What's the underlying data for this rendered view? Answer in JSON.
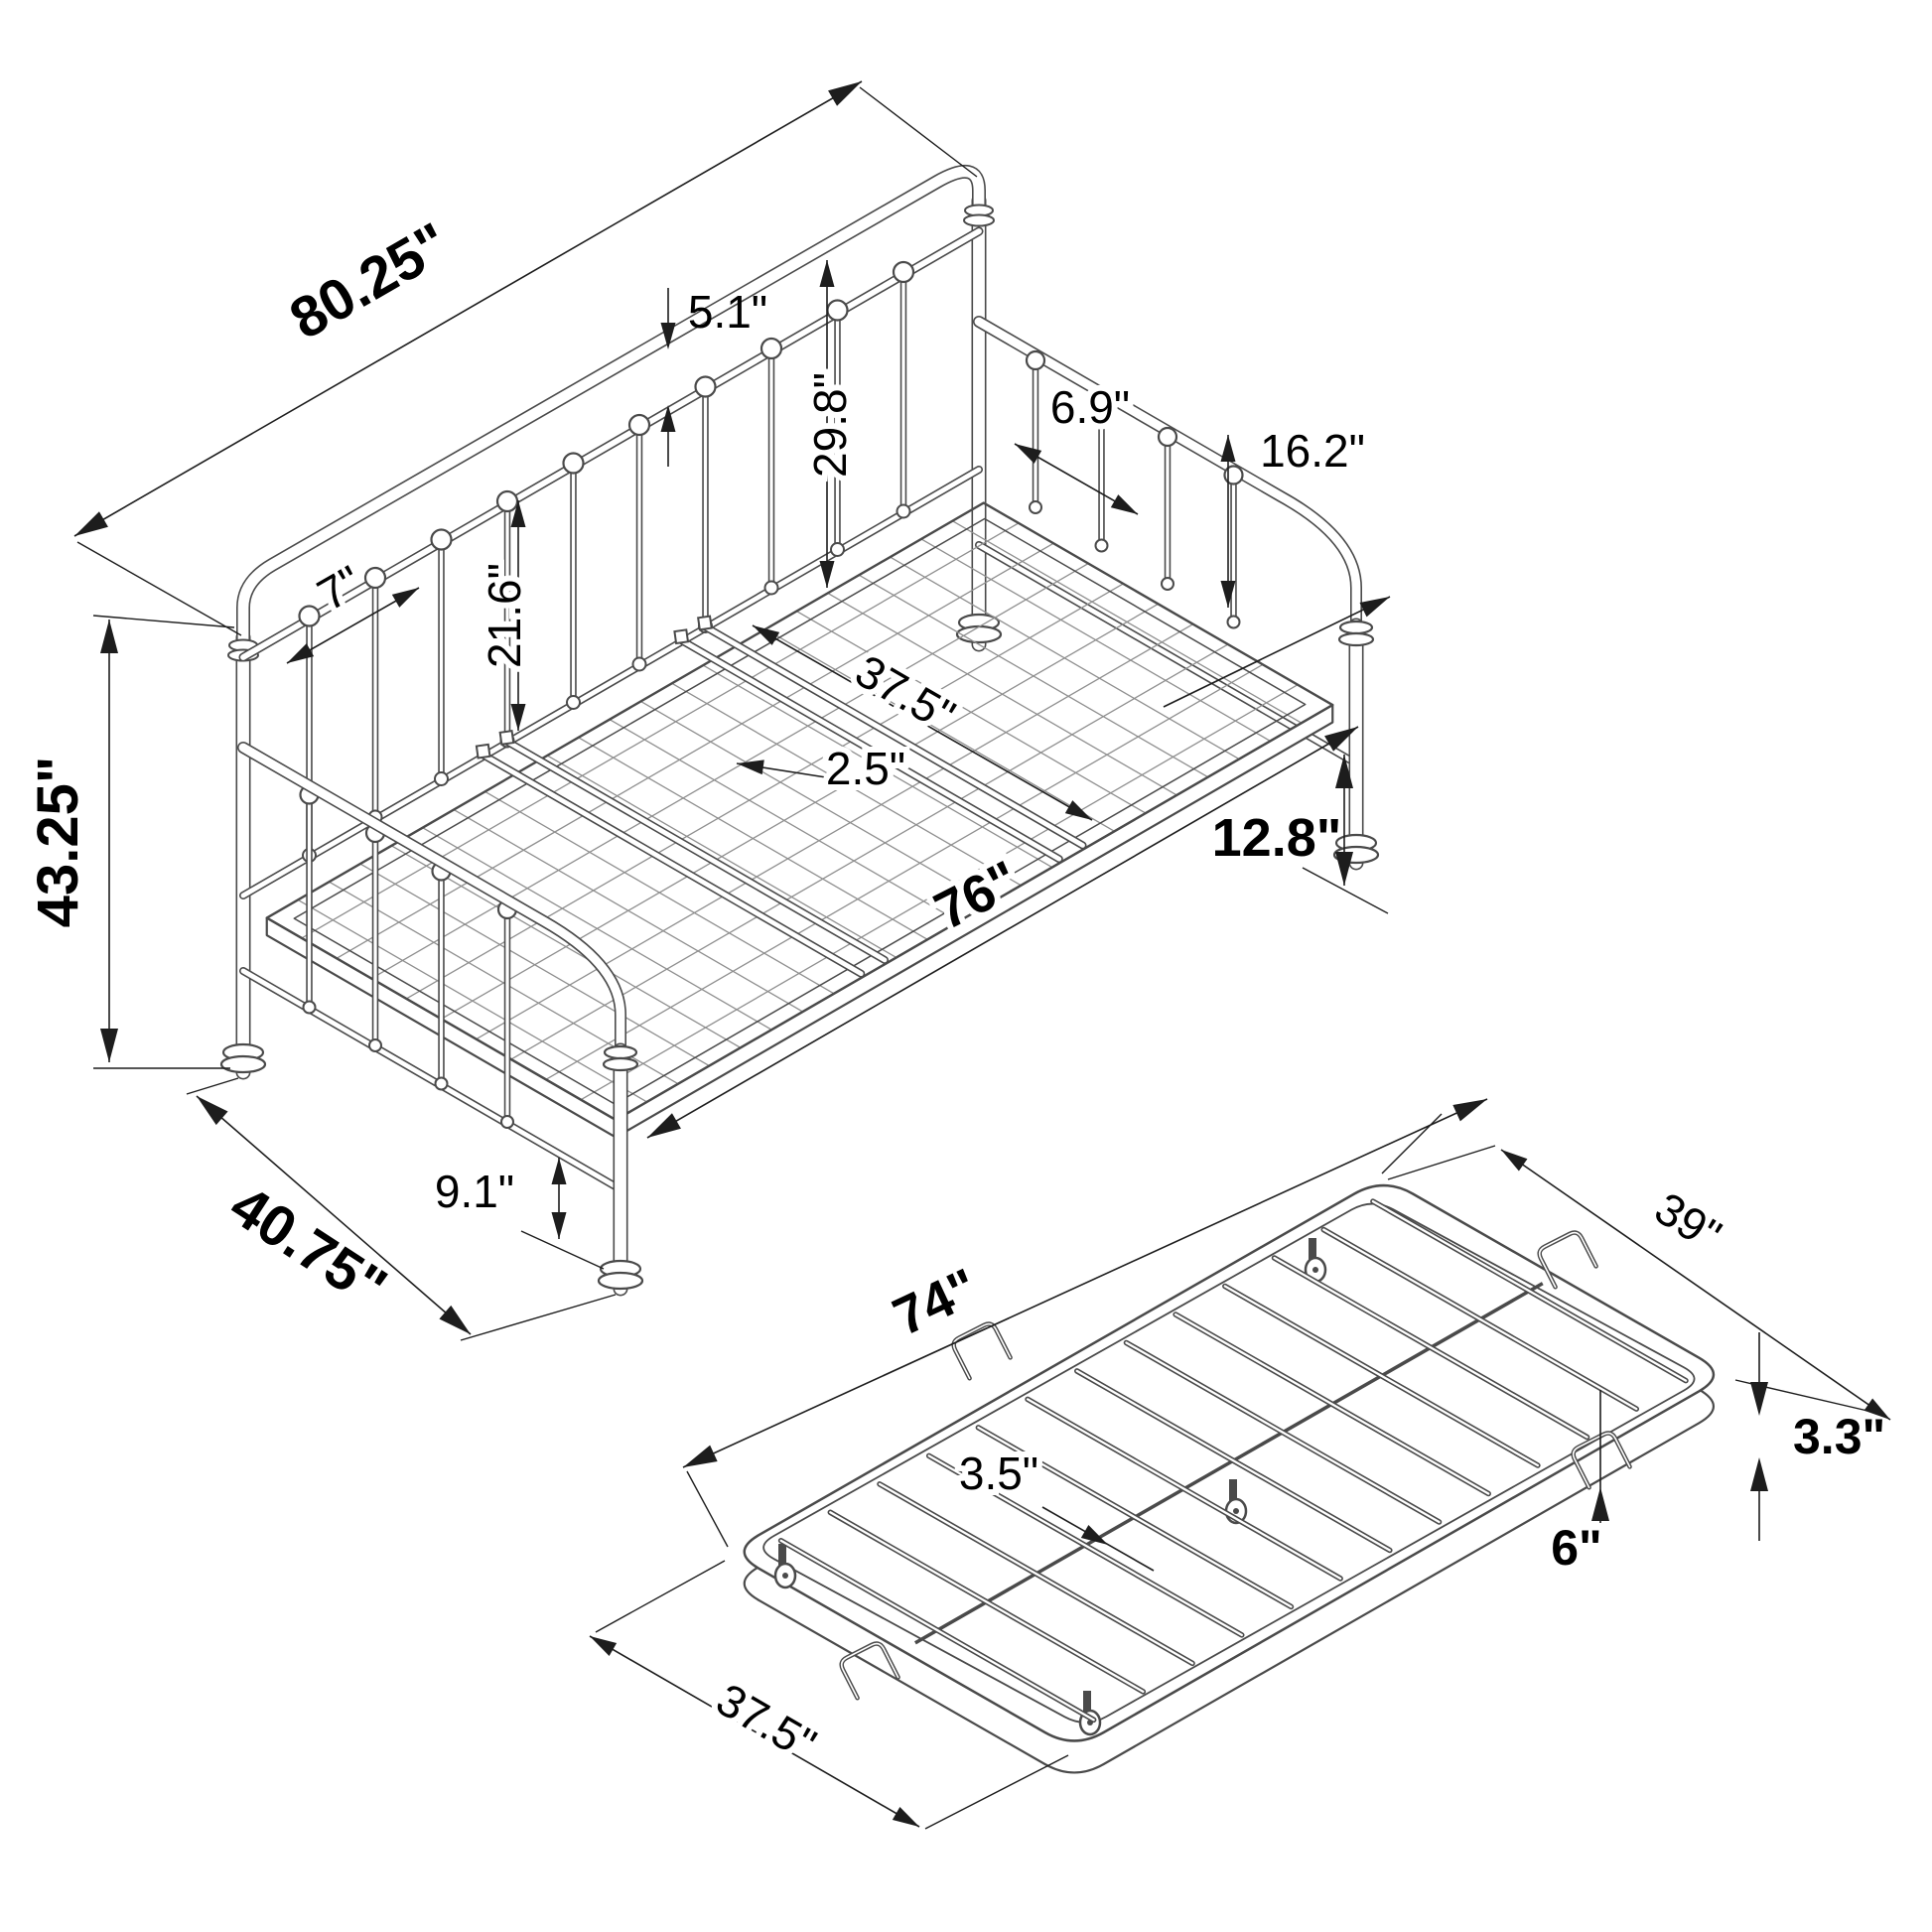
{
  "diagram": {
    "type": "Isometric dimension drawing of a metal daybed with roll-out trundle",
    "units": "inches"
  },
  "colors": {
    "background": "#ffffff",
    "line": "#4a4a4a",
    "mesh": "#8f8f8f",
    "dim": "#1d1d1d",
    "text": "#000000"
  },
  "daybed": {
    "name": "daybed-frame",
    "dimensions": {
      "back_length": "80.25\"",
      "overall_height": "43.25\"",
      "overall_depth": "40.75\"",
      "back_rail_gap": "5.1\"",
      "back_height": "29.8\"",
      "back_spindle_spacing": "7\"",
      "spindle_length": "21.6\"",
      "arm_spindle_spacing": "6.9\"",
      "arm_height": "16.2\"",
      "deck_width": "37.5\"",
      "support_bar_gap": "2.5\"",
      "deck_length": "76\"",
      "underbed_clearance": "12.8\"",
      "lower_rail_height": "9.1\""
    }
  },
  "trundle": {
    "name": "trundle-frame",
    "dimensions": {
      "length": "74\"",
      "width": "39\"",
      "slat_spacing": "3.5\"",
      "frame_height": "3.3\"",
      "handle_length": "6\"",
      "end_width": "37.5\""
    }
  }
}
